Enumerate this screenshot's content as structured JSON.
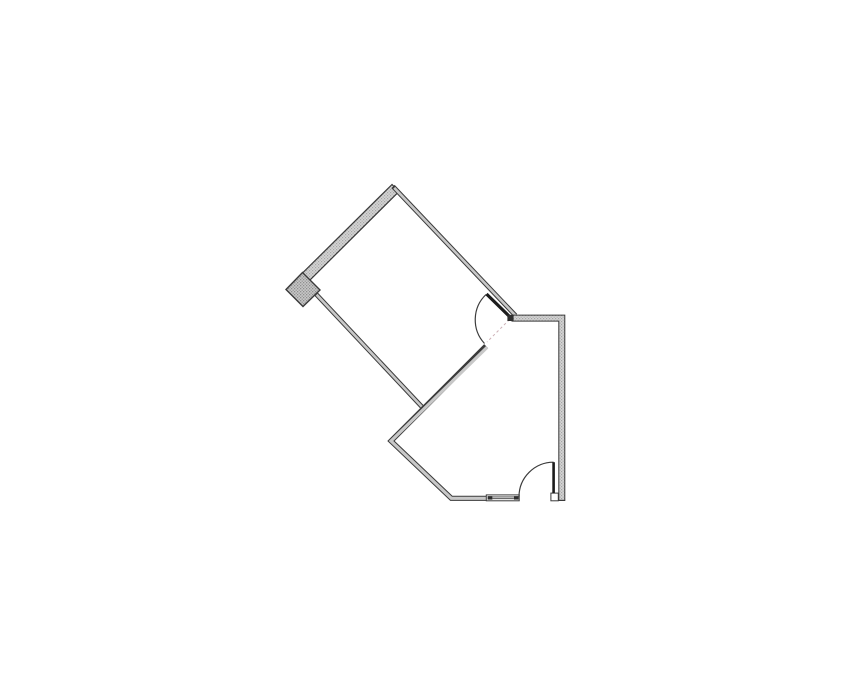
{
  "canvas": {
    "width": 855,
    "height": 678,
    "background": "#ffffff"
  },
  "colors": {
    "wall_line": "#3a3a3a",
    "wall_core": "#c8c8c8",
    "thick_wall_base": "#d4d4d4",
    "thick_wall_dot": "#a6a6a6",
    "block_base": "#c7c7c7",
    "block_dot": "#8f8f8f",
    "door_leaf": "#1c1c1c",
    "arc_line": "#3c3c3c",
    "swing_dash": "#ccb0b6",
    "window_fill": "#ffffff",
    "mullion_fill": "#2e2e2e"
  },
  "floor_plan": {
    "elements": [
      {
        "name": "exterior-thick-wall",
        "interactable": false,
        "type": "polygon",
        "points": [
          [
            392,
            184.5
          ],
          [
            302.5,
            273
          ],
          [
            309.5,
            280.5
          ],
          [
            399,
            191.5
          ]
        ],
        "fill": "stipple",
        "stroke_width": 1.2
      },
      {
        "name": "wall-end-block",
        "interactable": false,
        "type": "polygon",
        "points": [
          [
            302.5,
            272.5
          ],
          [
            320,
            290
          ],
          [
            303,
            306.5
          ],
          [
            286,
            289.5
          ]
        ],
        "fill": "stippleDark",
        "stroke_width": 1.4
      },
      {
        "name": "bedroom-top-right-wall",
        "interactable": false,
        "type": "wall",
        "outer": [
          [
            393,
            186.5
          ],
          [
            515.5,
            315.5
          ]
        ],
        "core": [
          [
            394.2,
            187.8
          ],
          [
            515.5,
            315.5
          ]
        ],
        "width": 4.6,
        "core_width": 2.6,
        "core_fill": "solid"
      },
      {
        "name": "bedroom-left-wall",
        "interactable": false,
        "type": "wall",
        "outer": [
          [
            315.5,
            293.5
          ],
          [
            423.5,
            408.5
          ]
        ],
        "core": [
          [
            316.6,
            294.7
          ],
          [
            423.5,
            408.5
          ]
        ],
        "width": 4.6,
        "core_width": 2.6,
        "core_fill": "solid"
      },
      {
        "name": "interior-and-bottom-wall",
        "interactable": false,
        "type": "wall",
        "outer": [
          [
            486,
            346
          ],
          [
            391,
            441
          ],
          [
            451.3,
            498.3
          ],
          [
            487.5,
            498.3
          ]
        ],
        "core": [
          [
            487.2,
            347.2
          ],
          [
            391,
            441
          ],
          [
            451.3,
            498.3
          ],
          [
            487.5,
            498.3
          ]
        ],
        "width": 5.2,
        "core_width": 3.2,
        "core_fill": "solid"
      },
      {
        "name": "right-room-wall",
        "interactable": false,
        "type": "wall",
        "outer": [
          [
            511.5,
            318.1
          ],
          [
            561.8,
            318.1
          ],
          [
            561.8,
            500.3
          ]
        ],
        "core": [
          [
            511.5,
            318.1
          ],
          [
            561.8,
            318.1
          ],
          [
            561.8,
            500.3
          ]
        ],
        "width": 7,
        "core_width": 5,
        "core_fill": "stipple"
      },
      {
        "name": "right-wall-bottom-edge",
        "interactable": false,
        "type": "line",
        "p1": [
          558.3,
          500.4
        ],
        "p2": [
          565.3,
          500.4
        ],
        "width": 1.2,
        "color_key": "wall_line"
      },
      {
        "name": "window-frame",
        "interactable": false,
        "type": "rect",
        "x": 486.3,
        "y": 494.9,
        "w": 32.9,
        "h": 5.9,
        "fill_key": "window_fill",
        "stroke_key": "wall_line",
        "stroke_width": 1
      },
      {
        "name": "window-mullion-left",
        "interactable": false,
        "type": "rect",
        "x": 487.6,
        "y": 496.1,
        "w": 4.8,
        "h": 3.5,
        "fill_key": "mullion_fill"
      },
      {
        "name": "window-mullion-right",
        "interactable": false,
        "type": "rect",
        "x": 513.9,
        "y": 496.1,
        "w": 4.8,
        "h": 3.5,
        "fill_key": "mullion_fill"
      },
      {
        "name": "window-glazing-line-top",
        "interactable": false,
        "type": "line",
        "p1": [
          492.4,
          496.9
        ],
        "p2": [
          513.9,
          496.9
        ],
        "width": 0.9,
        "color_key": "wall_line"
      },
      {
        "name": "window-glazing-line-bottom",
        "interactable": false,
        "type": "line",
        "p1": [
          492.4,
          498.7
        ],
        "p2": [
          513.9,
          498.7
        ],
        "width": 0.9,
        "color_key": "wall_line"
      },
      {
        "name": "door-jamb-block",
        "interactable": false,
        "type": "rect",
        "x": 550.9,
        "y": 493.1,
        "w": 7.4,
        "h": 7.7,
        "fill_key": "window_fill",
        "stroke_key": "wall_line",
        "stroke_width": 1
      },
      {
        "name": "upper-door-swing-dash-line",
        "interactable": false,
        "type": "line",
        "p1": [
          509.5,
          319.5
        ],
        "p2": [
          487,
          342
        ],
        "width": 1,
        "color_key": "swing_dash",
        "dash": "2.6 2.6"
      },
      {
        "name": "upper-door-arc",
        "interactable": false,
        "type": "path",
        "d": "M 486 294.5 A 35 35 0 0 0 484.5 343.5",
        "width": 1.2,
        "color_key": "arc_line"
      },
      {
        "name": "upper-door-leaf",
        "interactable": false,
        "type": "line",
        "p1": [
          510.5,
          317.5
        ],
        "p2": [
          486.5,
          294
        ],
        "width": 3.2,
        "color_key": "door_leaf"
      },
      {
        "name": "upper-door-hinge-block",
        "interactable": false,
        "type": "rect",
        "x": 507.4,
        "y": 314.8,
        "w": 6.2,
        "h": 6.2,
        "fill_key": "mullion_fill"
      },
      {
        "name": "lower-door-arc",
        "interactable": false,
        "type": "path",
        "d": "M 553.6 462.2 A 34.6 34.6 0 0 0 519 496.8",
        "width": 1.2,
        "color_key": "arc_line"
      },
      {
        "name": "lower-door-leaf",
        "interactable": false,
        "type": "line",
        "p1": [
          553.6,
          462.2
        ],
        "p2": [
          553.6,
          493.1
        ],
        "width": 2.6,
        "color_key": "door_leaf"
      }
    ]
  }
}
